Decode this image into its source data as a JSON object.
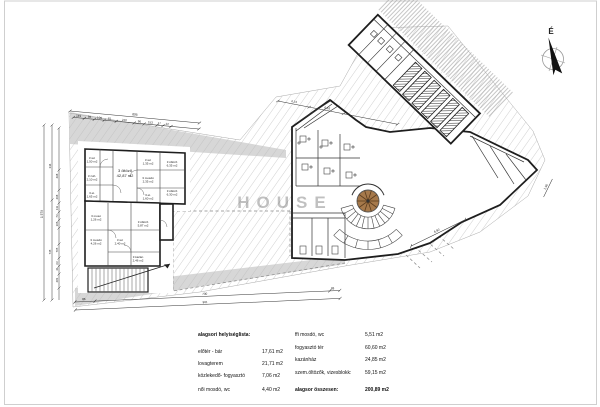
{
  "legend": {
    "header": "alagsori helyiséglista:",
    "left_rows": [
      {
        "label": "előtér - bár",
        "value": "17,61 m2"
      },
      {
        "label": "lovagterem",
        "value": "21,71 m2"
      },
      {
        "label": "közlekedő- fogyasztó",
        "value": "7,06 m2"
      },
      {
        "label": "női mosdó, wc",
        "value": "4,40 m2"
      }
    ],
    "right_rows": [
      {
        "label": "ffi mosdó, wc",
        "value": "5,51 m2"
      },
      {
        "label": "fogyasztó tér",
        "value": "60,60 m2"
      },
      {
        "label": "kazánház",
        "value": "24,85 m2"
      },
      {
        "label": "szem.öltözők, vizesblokk:",
        "value": "59,15 m2"
      }
    ],
    "total": {
      "label": "alagsor összesen:",
      "value": "200,89 m2"
    }
  },
  "compass": {
    "north_label": "É"
  },
  "watermark": "HOUSE",
  "dimensions": {
    "top_total": "895",
    "top_segments": [
      "149",
      "96",
      "106",
      "81",
      "220",
      "96",
      "153",
      "17",
      "22"
    ],
    "left_total": "1 579",
    "left_mid": [
      "344",
      "735"
    ],
    "left_inner": [
      "468",
      "208",
      "111",
      "73",
      "105",
      "705",
      "63",
      "41",
      "281"
    ],
    "bottom_segments": [
      "86",
      "730",
      "83"
    ],
    "bottom_total": "901",
    "plan_dims": [
      "4,14",
      "6,16",
      "6,92",
      "1,96"
    ]
  },
  "rooms": [
    {
      "label": "3 wc",
      "area": "1,50 m2"
    },
    {
      "label": "3 zuh.",
      "area": "2,10 m2"
    },
    {
      "label": "3 et.",
      "area": "1,65 m2"
    },
    {
      "label": "3 öltöző",
      "area": "42,87 m2"
    },
    {
      "label": "3 wc",
      "area": "1,35 m2"
    },
    {
      "label": "3 mosdó",
      "area": "2,35 m2"
    },
    {
      "label": "3 et.",
      "area": "1,60 m2"
    },
    {
      "label": "3 öltöző",
      "area": "6,35 m2"
    },
    {
      "label": "3 öltöző",
      "area": "6,30 m2"
    },
    {
      "label": "3 mosó",
      "area": "1,26 m2"
    },
    {
      "label": "3 öltöző",
      "area": "5,87 m2"
    },
    {
      "label": "3 mosdó",
      "area": "4,26 m2"
    },
    {
      "label": "3 wc",
      "area": "2,40 m2"
    },
    {
      "label": "3 kazán",
      "area": "2,46 m2"
    }
  ],
  "colors": {
    "stair_accent": "#a6794b",
    "hatch_line": "#bcbcbc",
    "street_band": "#d7d7d7"
  }
}
